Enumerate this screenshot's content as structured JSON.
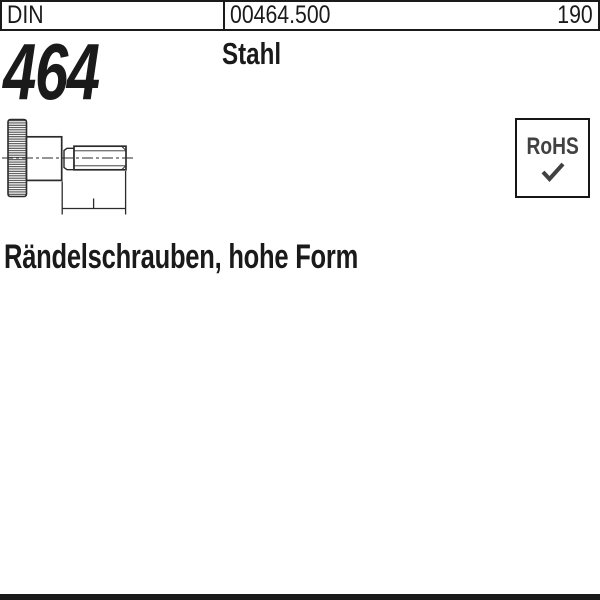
{
  "header": {
    "standard": "DIN",
    "article_number": "00464.500",
    "page_number": "190"
  },
  "product": {
    "din_number": "464",
    "material": "Stahl",
    "title": "Rändelschrauben, hohe Form"
  },
  "rohs_badge": {
    "label": "RoHS",
    "check_icon": "check-mark"
  },
  "drawing": {
    "alt": "Side view technical drawing of a knurled thumb screw, high form, with centerline and thread length dimension"
  },
  "colors": {
    "text": "#1a1a1a",
    "drawing_line": "#2b2b2b",
    "rohs_text": "#414141",
    "bottom_bar": "#1a1a1a"
  }
}
